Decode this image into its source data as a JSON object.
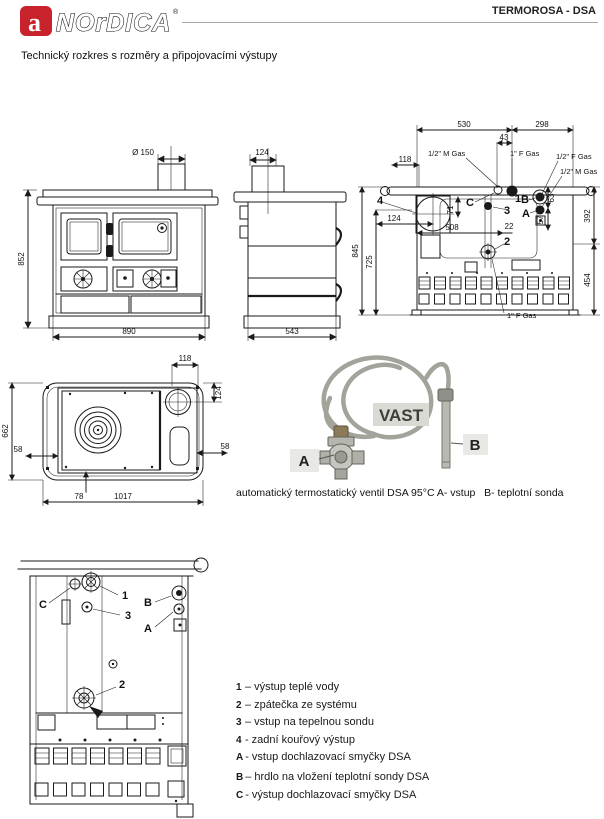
{
  "colors": {
    "brand_red": "#c8232c",
    "line_black": "#1a1a1a",
    "rule_gray": "#a8a8a8"
  },
  "header": {
    "logo_letter": "a",
    "brand": "NOrDICA",
    "registered": "®",
    "product": "TERMOROSA - DSA"
  },
  "subtitle": "Technický rozkres s rozměry a připojovacími výstupy",
  "front_view": {
    "flue_diameter": "Ø 150",
    "height": "852",
    "width": "890"
  },
  "side_view": {
    "flue_offset": "124",
    "depth": "543"
  },
  "rear_view": {
    "dim_530": "530",
    "dim_298": "298",
    "dim_43": "43",
    "dim_118": "118",
    "dim_845": "845",
    "dim_725": "725",
    "dim_124": "124",
    "dim_508": "508",
    "dim_22": "22",
    "dim_71": "71",
    "dim_63": "63",
    "dim_57": "57",
    "dim_392": "392",
    "dim_454": "454",
    "label_half_m_gas_top": "1/2\" M Gas",
    "label_one_f_gas_top": "1\" F Gas",
    "label_half_f_gas": "1/2\" F Gas",
    "label_half_m_gas_right": "1/2\" M Gas",
    "label_one_f_gas_bottom": "1\" F Gas",
    "callout_4": "4",
    "callout_c": "C",
    "callout_1": "1",
    "callout_3": "3",
    "callout_b": "B",
    "callout_a": "A",
    "callout_2": "2"
  },
  "top_view": {
    "dim_118": "118",
    "dim_124": "124",
    "dim_662": "662",
    "dim_58_left": "58",
    "dim_58_right": "58",
    "dim_78": "78",
    "dim_1017": "1017"
  },
  "valve": {
    "tag": "VAST",
    "label_a": "A",
    "label_b": "B",
    "caption": "automatický termostatický ventil DSA 95°C A- vstup   B- teplotní sonda"
  },
  "detail_view": {
    "callout_c": "C",
    "callout_1": "1",
    "callout_3": "3",
    "callout_b": "B",
    "callout_a": "A",
    "callout_2": "2"
  },
  "legend": {
    "items": [
      {
        "key": "1",
        "sep": "–",
        "text": "výstup teplé vody"
      },
      {
        "key": "2",
        "sep": "–",
        "text": "zpátečka ze systému"
      },
      {
        "key": "3",
        "sep": "–",
        "text": "vstup na tepelnou sondu"
      },
      {
        "key": "4",
        "sep": "-",
        "text": "zadní kouřový výstup"
      },
      {
        "key": "A",
        "sep": "-",
        "text": "vstup dochlazovací smyčky DSA"
      },
      {
        "key": "B",
        "sep": "–",
        "text": "hrdlo na vložení teplotní sondy DSA"
      },
      {
        "key": "C",
        "sep": "-",
        "text": "výstup dochlazovací smyčky DSA"
      }
    ]
  }
}
